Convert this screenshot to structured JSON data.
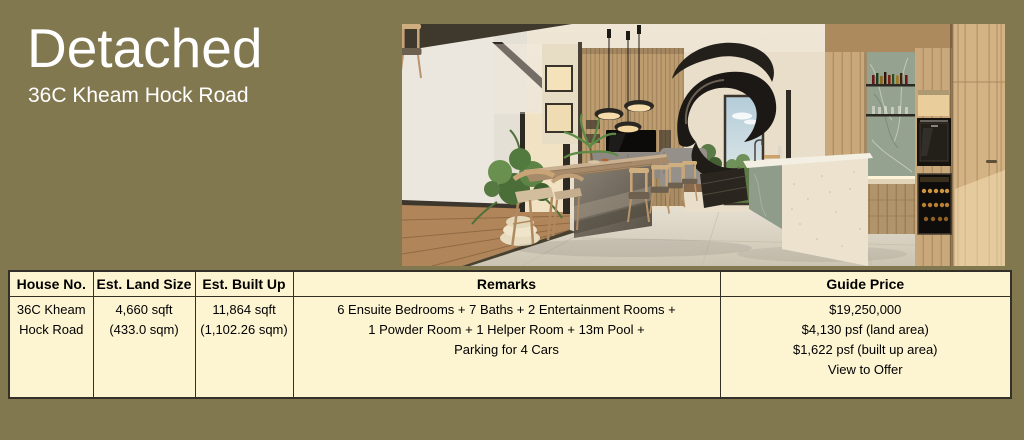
{
  "hero": {
    "title": "Detached",
    "subtitle": "36C Kheam Hock Road"
  },
  "table": {
    "headers": [
      "House No.",
      "Est. Land Size",
      "Est. Built Up",
      "Remarks",
      "Guide Price"
    ],
    "row": {
      "house_no": "36C Kheam\nHock Road",
      "est_land_size": "4,660 sqft\n(433.0 sqm)",
      "est_built_up": "11,864 sqft\n(1,102.26 sqm)",
      "remarks": "6 Ensuite Bedrooms + 7 Baths + 2 Entertainment Rooms +\n1 Powder Room + 1 Helper Room + 13m Pool +\nParking for 4 Cars",
      "guide_price": "$19,250,000\n$4,130 psf (land area)\n$1,622 psf (built up area)\nView to Offer"
    }
  },
  "colors": {
    "page-bg": "#827850",
    "table-bg": "#fdf4d2",
    "table-border": "#33302a",
    "table-text": "#000000",
    "title-color": "#ffffff"
  }
}
